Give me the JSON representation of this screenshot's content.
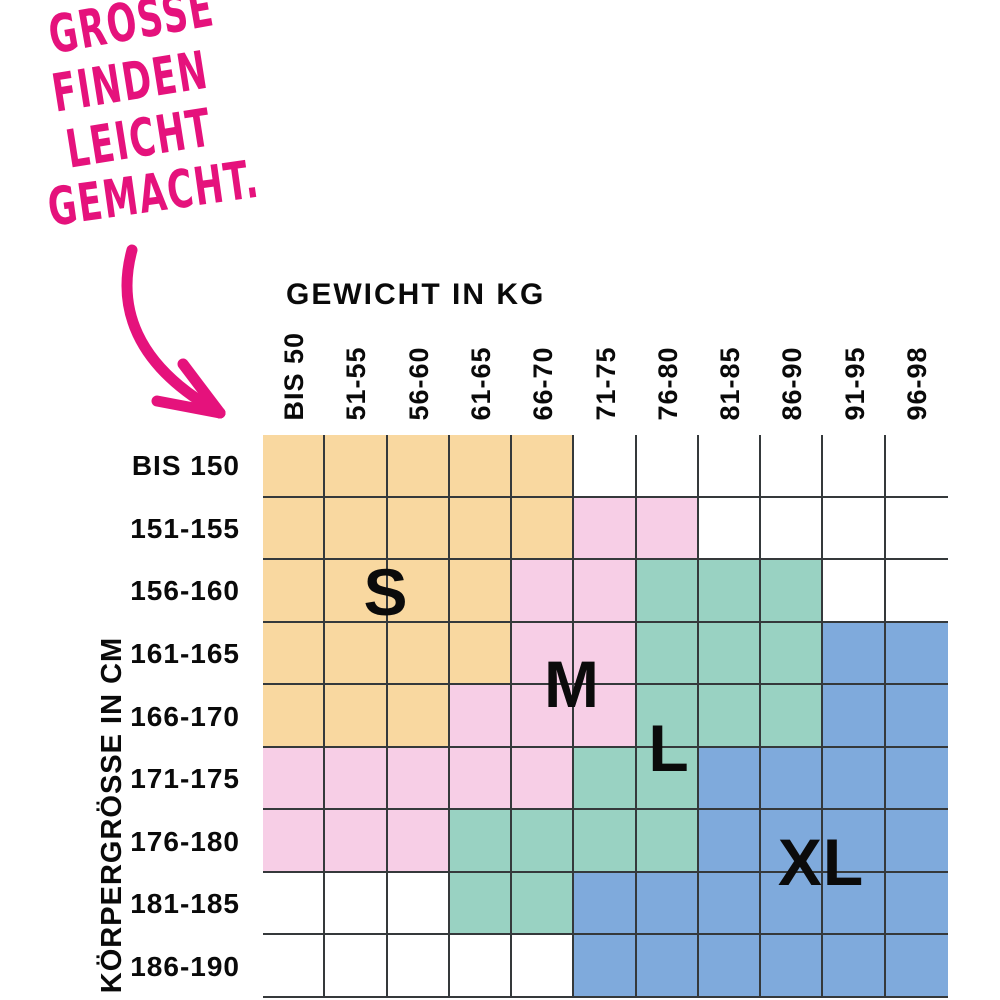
{
  "annotation": {
    "lines": [
      "GRÖSSE",
      "FINDEN",
      "LEICHT",
      "GEMACHT."
    ],
    "color": "#E5127C"
  },
  "weight_axis": {
    "title": "GEWICHT IN KG",
    "labels": [
      "BIS 50",
      "51-55",
      "56-60",
      "61-65",
      "66-70",
      "71-75",
      "76-80",
      "81-85",
      "86-90",
      "91-95",
      "96-98"
    ]
  },
  "height_axis": {
    "title": "KÖRPERGRÖSSE IN CM",
    "labels": [
      "BIS 150",
      "151-155",
      "156-160",
      "161-165",
      "166-170",
      "171-175",
      "176-180",
      "181-185",
      "186-190"
    ]
  },
  "size_labels": {
    "s": "S",
    "m": "M",
    "l": "L",
    "xl": "XL"
  },
  "palette": {
    "S": "#F9D8A0",
    "M": "#F7CEE6",
    "L": "#99D2C2",
    "XL": "#7FAADC",
    "grid_line": "#35393B",
    "text": "#0A0A0A",
    "accent": "#E5127C"
  },
  "chart_data": {
    "type": "heatmap",
    "title": "GRÖSSE FINDEN LEICHT GEMACHT.",
    "xlabel": "GEWICHT IN KG",
    "ylabel": "KÖRPERGRÖSSE IN CM",
    "x_categories": [
      "BIS 50",
      "51-55",
      "56-60",
      "61-65",
      "66-70",
      "71-75",
      "76-80",
      "81-85",
      "86-90",
      "91-95",
      "96-98"
    ],
    "y_categories": [
      "BIS 150",
      "151-155",
      "156-160",
      "161-165",
      "166-170",
      "171-175",
      "176-180",
      "181-185",
      "186-190"
    ],
    "legend": [
      "S",
      "M",
      "L",
      "XL"
    ],
    "grid": "on",
    "cells": [
      [
        "S",
        "S",
        "S",
        "S",
        "S",
        "",
        "",
        "",
        "",
        "",
        ""
      ],
      [
        "S",
        "S",
        "S",
        "S",
        "S",
        "M",
        "M",
        "",
        "",
        "",
        ""
      ],
      [
        "S",
        "S",
        "S",
        "S",
        "M",
        "M",
        "L",
        "L",
        "L",
        "",
        ""
      ],
      [
        "S",
        "S",
        "S",
        "S",
        "M",
        "M",
        "L",
        "L",
        "L",
        "XL",
        "XL"
      ],
      [
        "S",
        "S",
        "S",
        "M",
        "M",
        "M",
        "L",
        "L",
        "L",
        "XL",
        "XL"
      ],
      [
        "M",
        "M",
        "M",
        "M",
        "M",
        "L",
        "L",
        "XL",
        "XL",
        "XL",
        "XL"
      ],
      [
        "M",
        "M",
        "M",
        "L",
        "L",
        "L",
        "L",
        "XL",
        "XL",
        "XL",
        "XL"
      ],
      [
        "",
        "",
        "",
        "L",
        "L",
        "XL",
        "XL",
        "XL",
        "XL",
        "XL",
        "XL"
      ],
      [
        "",
        "",
        "",
        "",
        "",
        "XL",
        "XL",
        "XL",
        "XL",
        "XL",
        "XL"
      ]
    ]
  }
}
